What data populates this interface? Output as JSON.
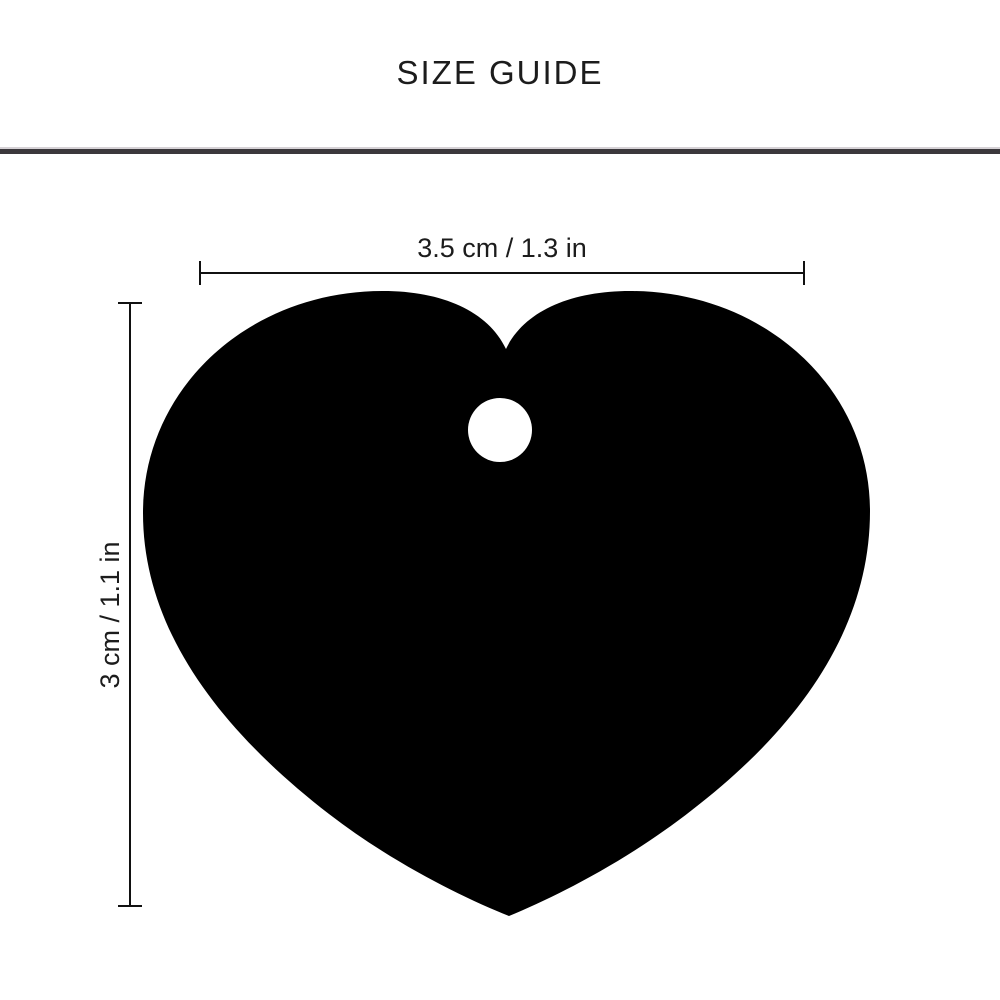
{
  "page": {
    "title": "SIZE GUIDE"
  },
  "tag": {
    "shape": "heart-pet-tag-silhouette",
    "fill_color": "#000000",
    "hole_color": "#ffffff"
  },
  "dimensions": {
    "width": {
      "label": "3.5 cm / 1.3 in"
    },
    "height": {
      "label": "3 cm / 1.1 in"
    }
  },
  "style": {
    "dimension_line_color": "#111111",
    "text_color": "#1c1c1c",
    "divider_dark": "#3b383c",
    "divider_light": "#d6d2d6",
    "background": "#ffffff"
  }
}
